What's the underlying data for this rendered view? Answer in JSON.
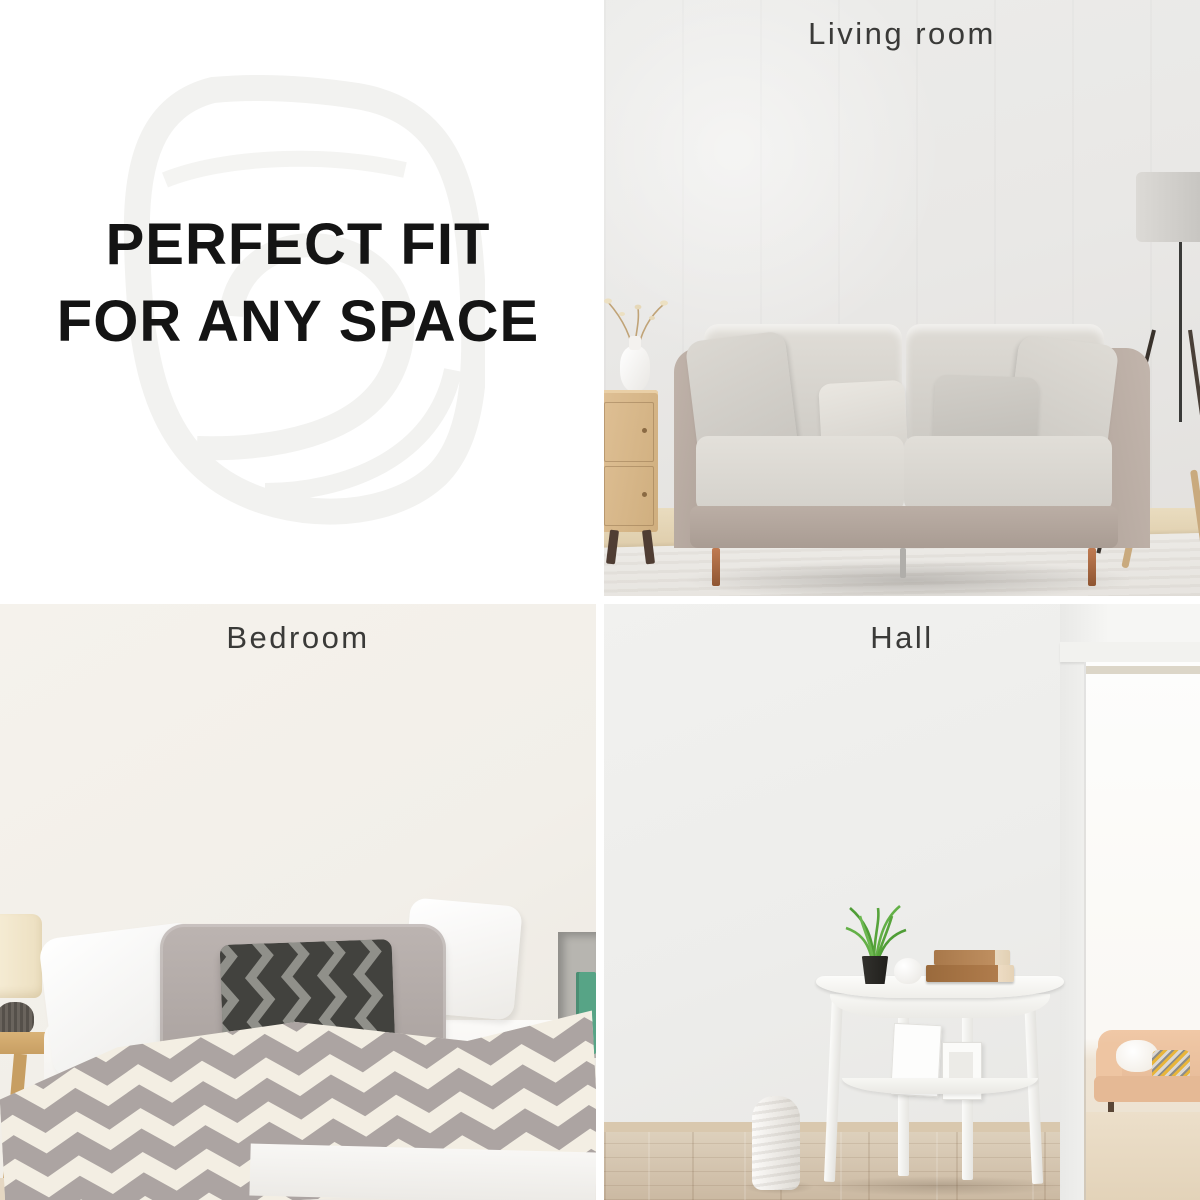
{
  "promo": {
    "heading_line1": "PERFECT FIT",
    "heading_line2": "FOR ANY SPACE"
  },
  "sections": {
    "living_room": {
      "label": "Living room"
    },
    "bedroom": {
      "label": "Bedroom"
    },
    "hall": {
      "label": "Hall"
    }
  },
  "map": {
    "oceans": {
      "arctic": [
        "ARCTIC",
        "OCEAN"
      ],
      "atlantic": [
        "ATLANTIC",
        "OCEAN"
      ],
      "pacific": [
        "PACIFIC",
        "OCEAN"
      ],
      "southern": [
        "SOUTHERN",
        "OCEAN"
      ],
      "indian": [
        "INDIAN",
        "OCEAN"
      ]
    },
    "countries": {
      "greenland": "GREENLAND",
      "canada": "CANADA",
      "usa": "USA",
      "brazil": "BRAZIL",
      "russia": "RUSSIA",
      "kazakhstan": "KAZAKHSTAN",
      "china": "CHINA",
      "australia": "AUSTRALIA",
      "antarctica": "ANTARCTICA"
    },
    "colors": {
      "dark_wood": "#473a30",
      "burgundy": "#9a322c",
      "cream": "#e8dec6",
      "tan": "#dbc69e",
      "gray_wood": "#ccc5b6",
      "accent_blue": "#45b8d6",
      "ocean_label": "#8e2420"
    }
  }
}
